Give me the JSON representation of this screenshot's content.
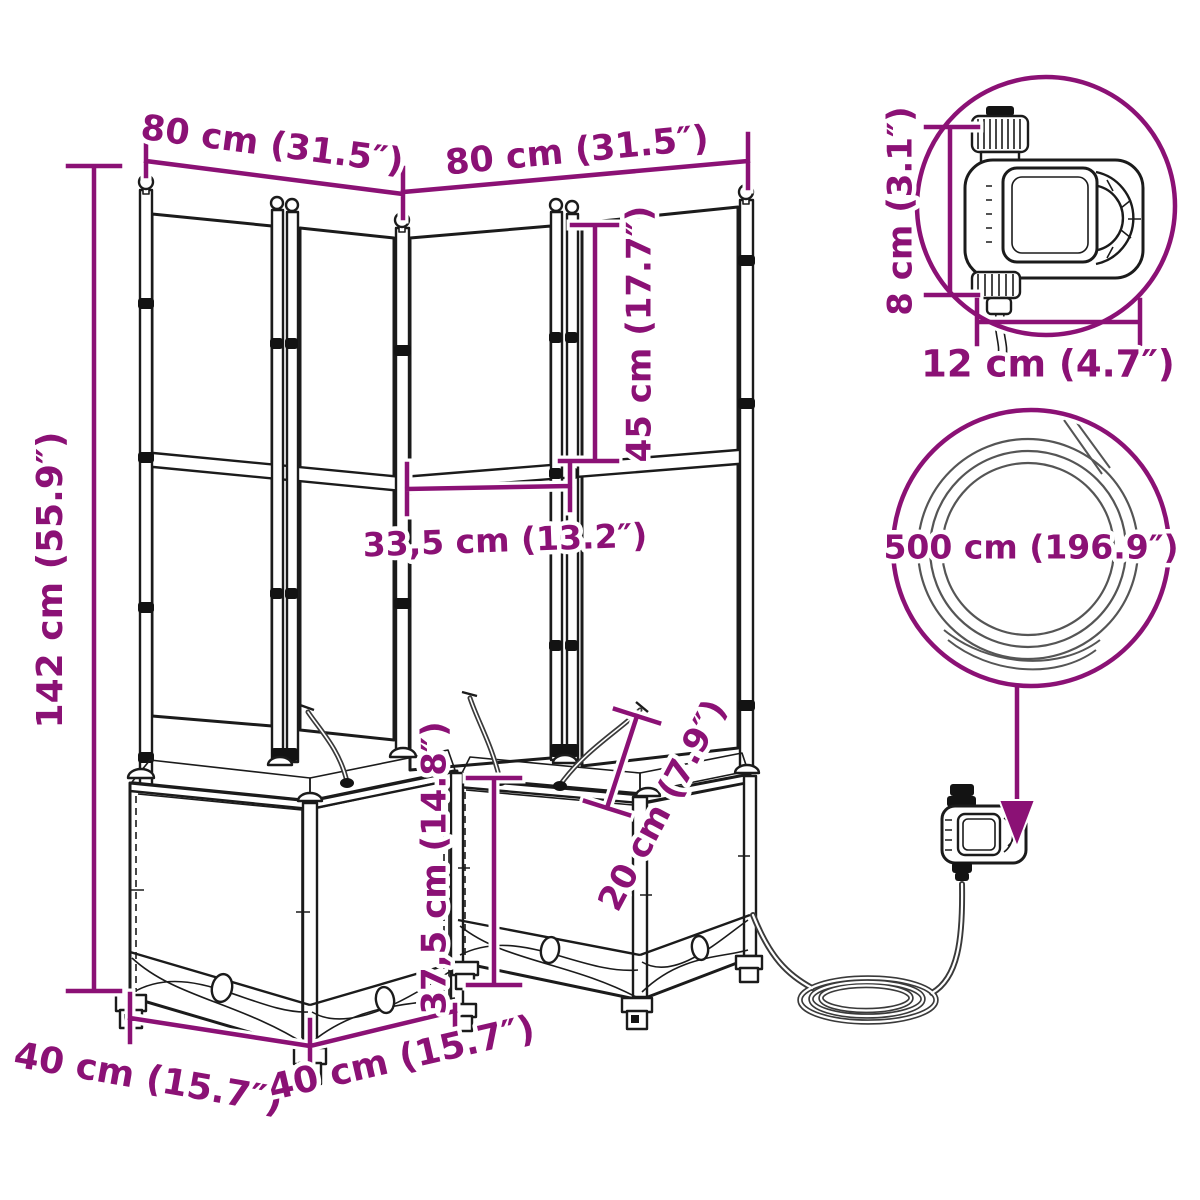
{
  "diagram": {
    "type": "product-dimension-diagram",
    "subject": "corner garden planter with trellis and automatic drip-watering kit"
  },
  "colors": {
    "dimension_accent": "#8B1175",
    "line_art": "#1B1B1B",
    "background": "#FFFFFF"
  },
  "dimensions": {
    "trellis_width_left": {
      "label": "80 cm (31.5″)"
    },
    "trellis_width_right": {
      "label": "80 cm (31.5″)"
    },
    "total_height": {
      "label": "142 cm (55.9″)"
    },
    "upper_trellis_height": {
      "label": "45 cm (17.7″)"
    },
    "panel_width": {
      "label": "33,5 cm (13.2″)"
    },
    "box_height": {
      "label": "37,5 cm (14.8″)"
    },
    "box_depth": {
      "label": "20 cm (7.9″)"
    },
    "box_width_left": {
      "label": "40 cm (15.7″)"
    },
    "box_width_right": {
      "label": "40 cm (15.7″)"
    },
    "timer_height": {
      "label": "8 cm (3.1″)"
    },
    "timer_width": {
      "label": "12 cm (4.7″)"
    },
    "hose_length": {
      "label": "500 cm (196.9″)"
    }
  }
}
